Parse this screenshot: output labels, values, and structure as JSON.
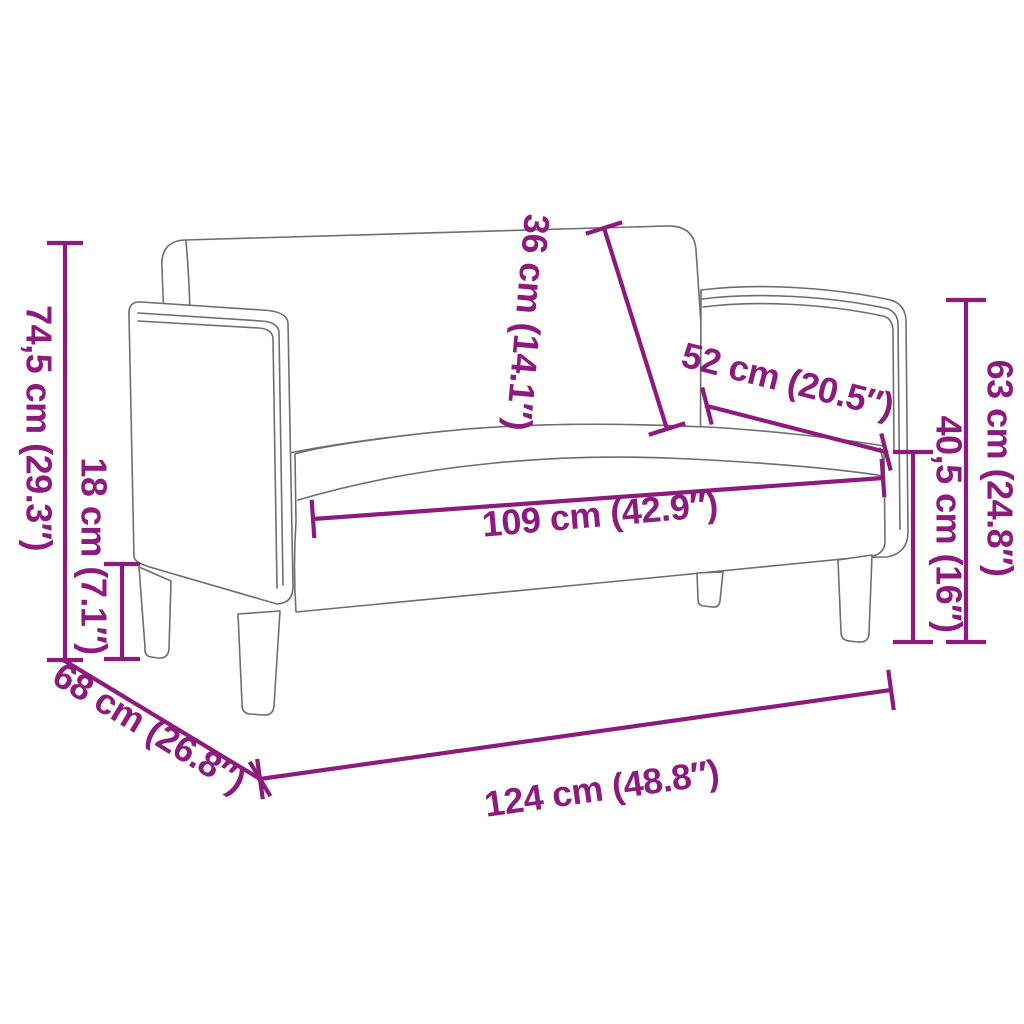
{
  "colors": {
    "dimension_accent": "#8d1a7d",
    "drawing_outline": "#6e6e6e",
    "background": "#ffffff"
  },
  "diagram": {
    "subject": "loveseat-sofa-line-drawing",
    "dimensions": [
      {
        "id": "total-height",
        "label": "74,5 cm (29.3″)"
      },
      {
        "id": "leg-height",
        "label": "18 cm (7.1″)"
      },
      {
        "id": "backrest-height",
        "label": "36 cm (14.1″)"
      },
      {
        "id": "armrest-depth",
        "label": "52 cm (20.5″)"
      },
      {
        "id": "seat-width",
        "label": "109 cm (42.9″)"
      },
      {
        "id": "back-height",
        "label": "63 cm (24.8″)"
      },
      {
        "id": "seat-height",
        "label": "40,5 cm (16″)"
      },
      {
        "id": "total-depth",
        "label": "68 cm (26.8″)"
      },
      {
        "id": "total-width",
        "label": "124 cm (48.8″)"
      }
    ]
  }
}
